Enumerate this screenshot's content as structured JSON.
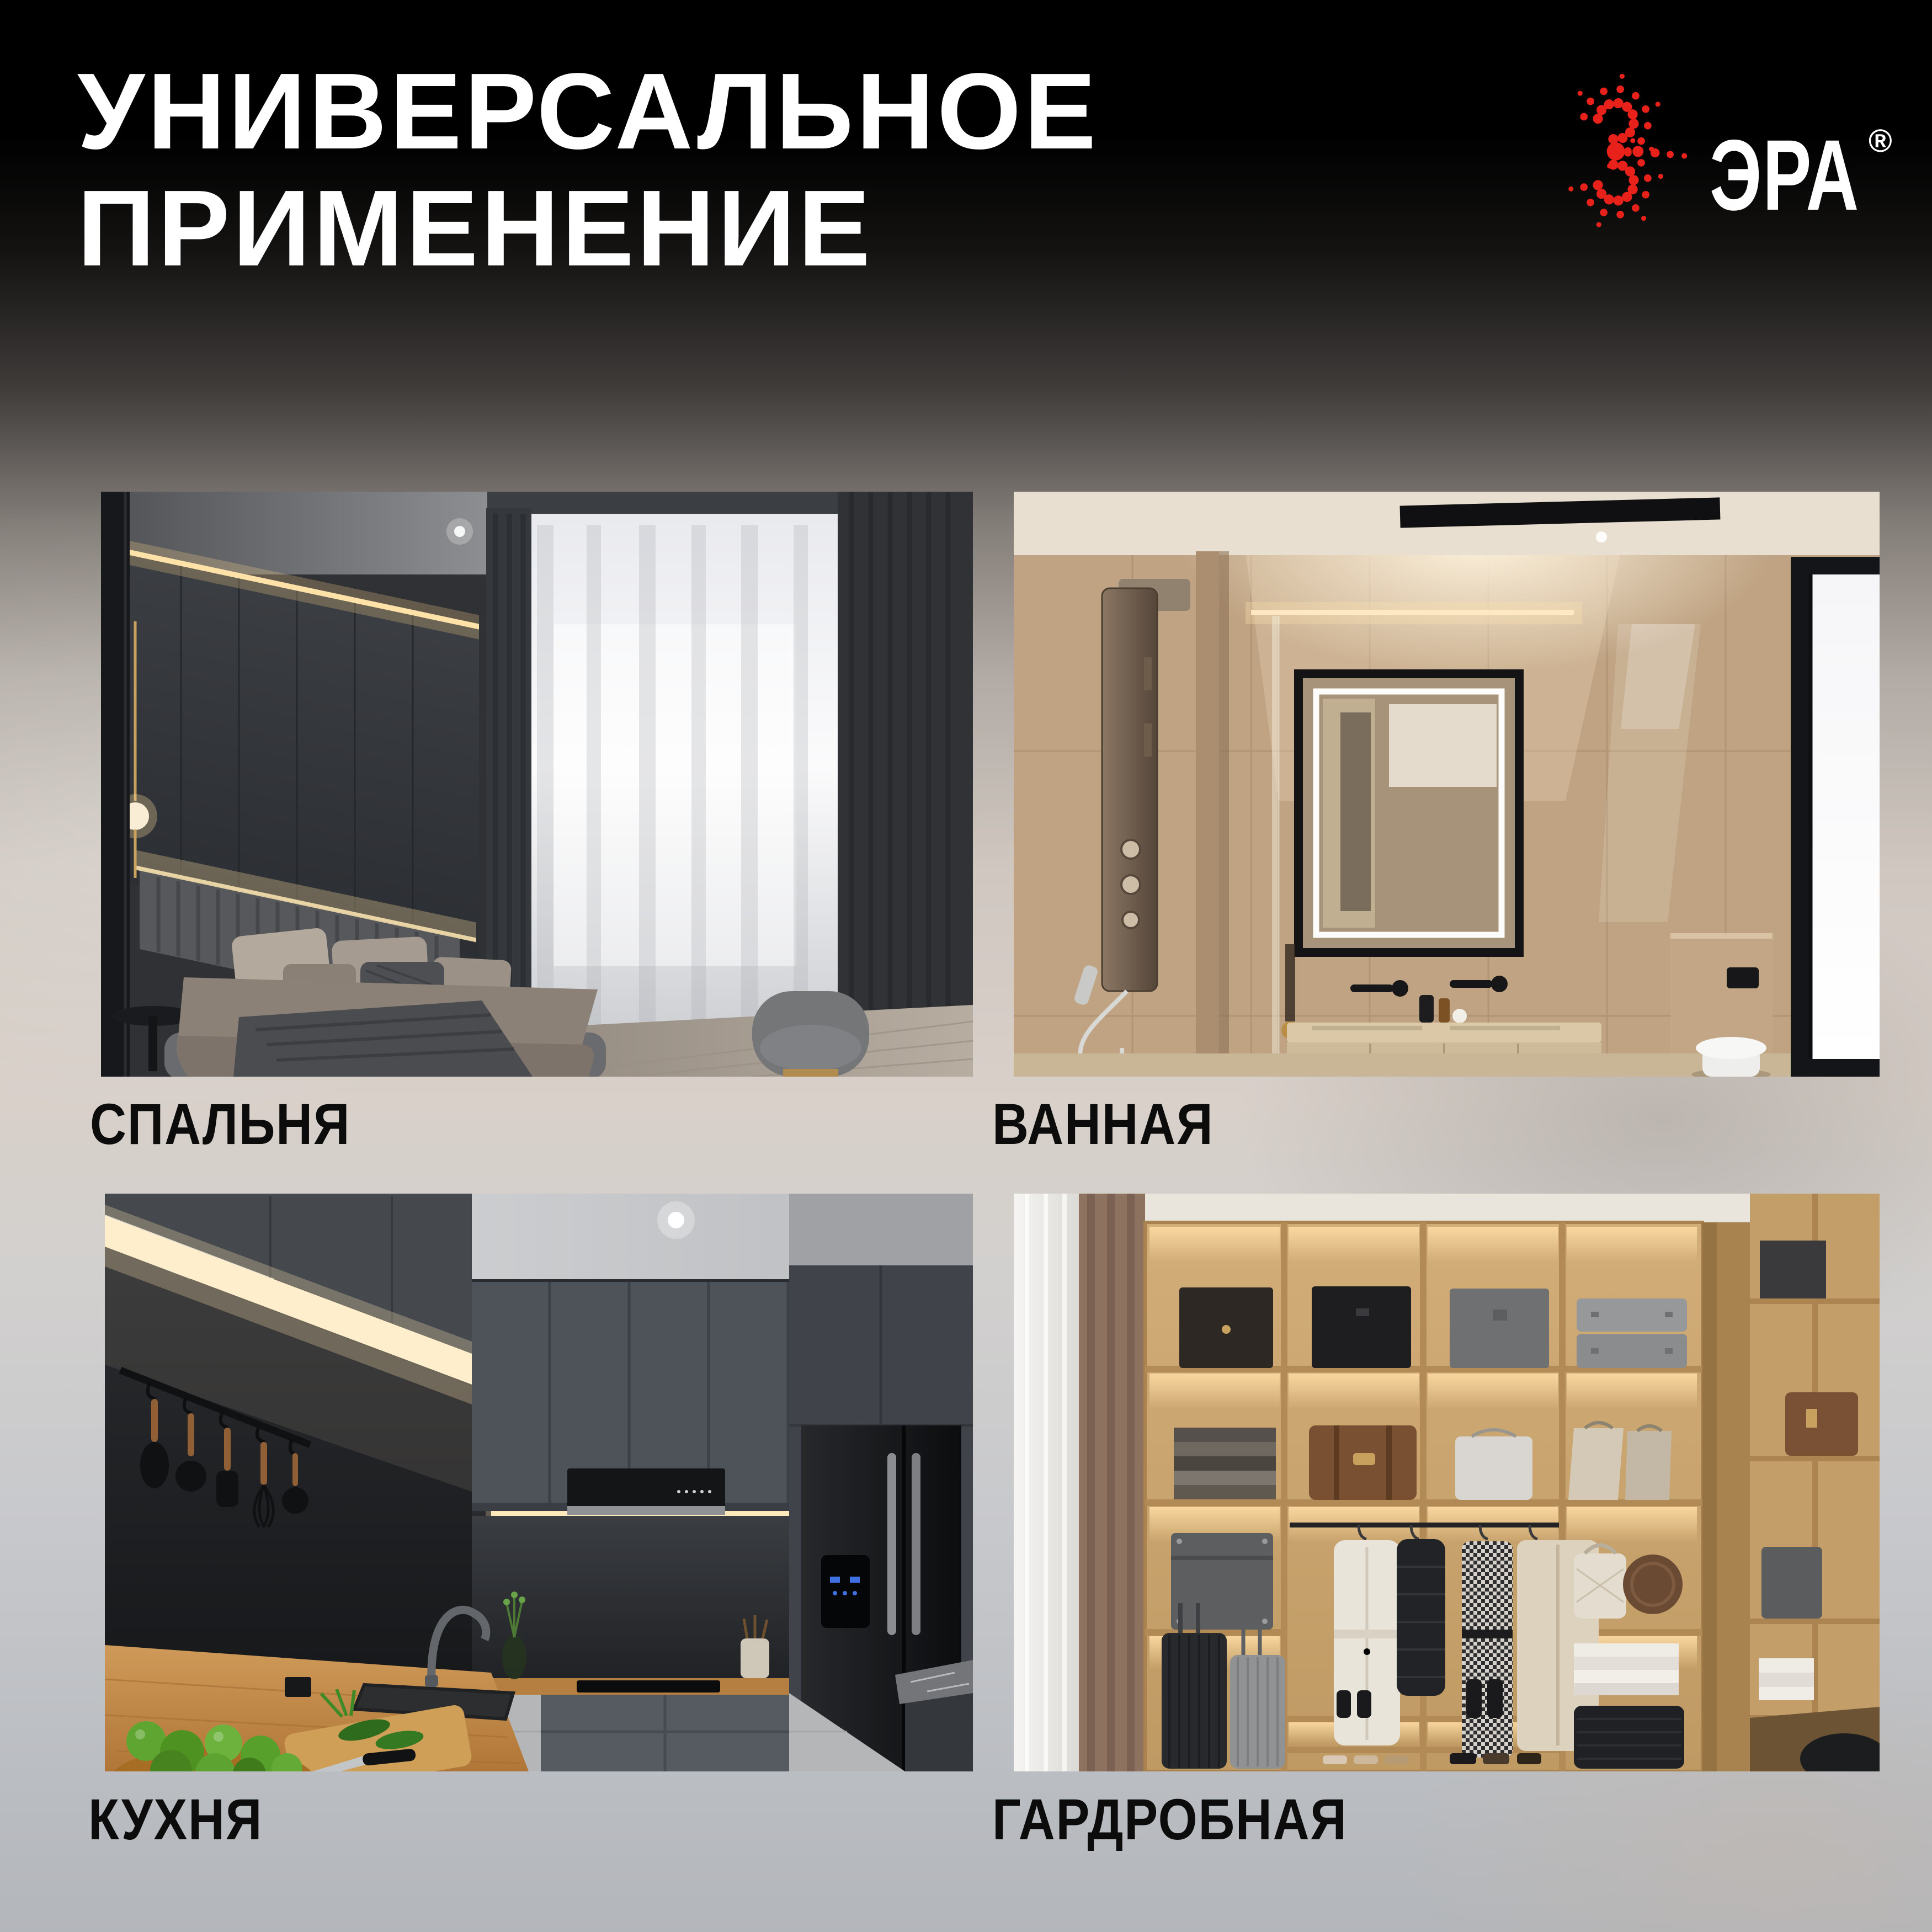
{
  "header": {
    "title_line1": "УНИВЕРСАЛЬНОЕ",
    "title_line2": "ПРИМЕНЕНИЕ",
    "title_color": "#ffffff"
  },
  "logo": {
    "brand": "ЭРА",
    "registered_mark": "®",
    "dot_color": "#e8211a",
    "text_color": "#ffffff"
  },
  "cards": [
    {
      "id": "bedroom",
      "label": "СПАЛЬНЯ"
    },
    {
      "id": "bathroom",
      "label": "ВАННАЯ"
    },
    {
      "id": "kitchen",
      "label": "КУХНЯ"
    },
    {
      "id": "wardrobe",
      "label": "ГАРДРОБНАЯ"
    }
  ],
  "label_color": "#0c0c0c",
  "background": {
    "top": "#000000",
    "middle": "#d8d0c9",
    "bottom": "#b3b6ba"
  }
}
